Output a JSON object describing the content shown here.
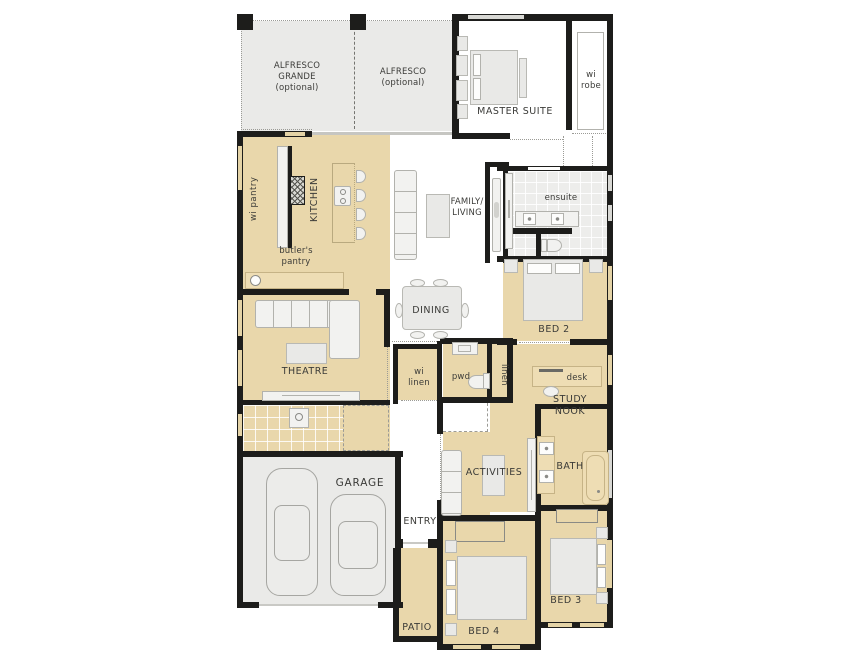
{
  "plan_title": "Single storey home floor plan",
  "colors": {
    "wall": "#1d1d1b",
    "room_tan": "#e9d7ab",
    "area_gray": "#eaeae8",
    "tile_gray": "#ededeb",
    "furniture": "#f2f2f0",
    "furniture_border": "#b2b2ad",
    "window_gray": "#d8d8d4",
    "window_tan": "#e4d3a6",
    "text": "#3b3b38"
  },
  "rooms": {
    "alfresco_grande": "ALFRESCO\nGRANDE\n(optional)",
    "alfresco": "ALFRESCO\n(optional)",
    "master_suite": "MASTER SUITE",
    "wi_robe": "wi\nrobe",
    "wi_pantry": "wi pantry",
    "kitchen": "KITCHEN",
    "butlers_pantry": "butler's\npantry",
    "family_living": "FAMILY/\nLIVING",
    "ensuite": "ensuite",
    "dining": "DINING",
    "bed2": "BED 2",
    "theatre": "THEATRE",
    "wi_linen": "wi\nlinen",
    "pwd": "pwd",
    "linen": "linen",
    "desk": "desk",
    "study_nook": "STUDY\nNOOK",
    "garage": "GARAGE",
    "entry": "ENTRY",
    "activities": "ACTIVITIES",
    "bath": "BATH",
    "bed4": "BED 4",
    "bed3": "BED 3",
    "patio": "PATIO"
  }
}
